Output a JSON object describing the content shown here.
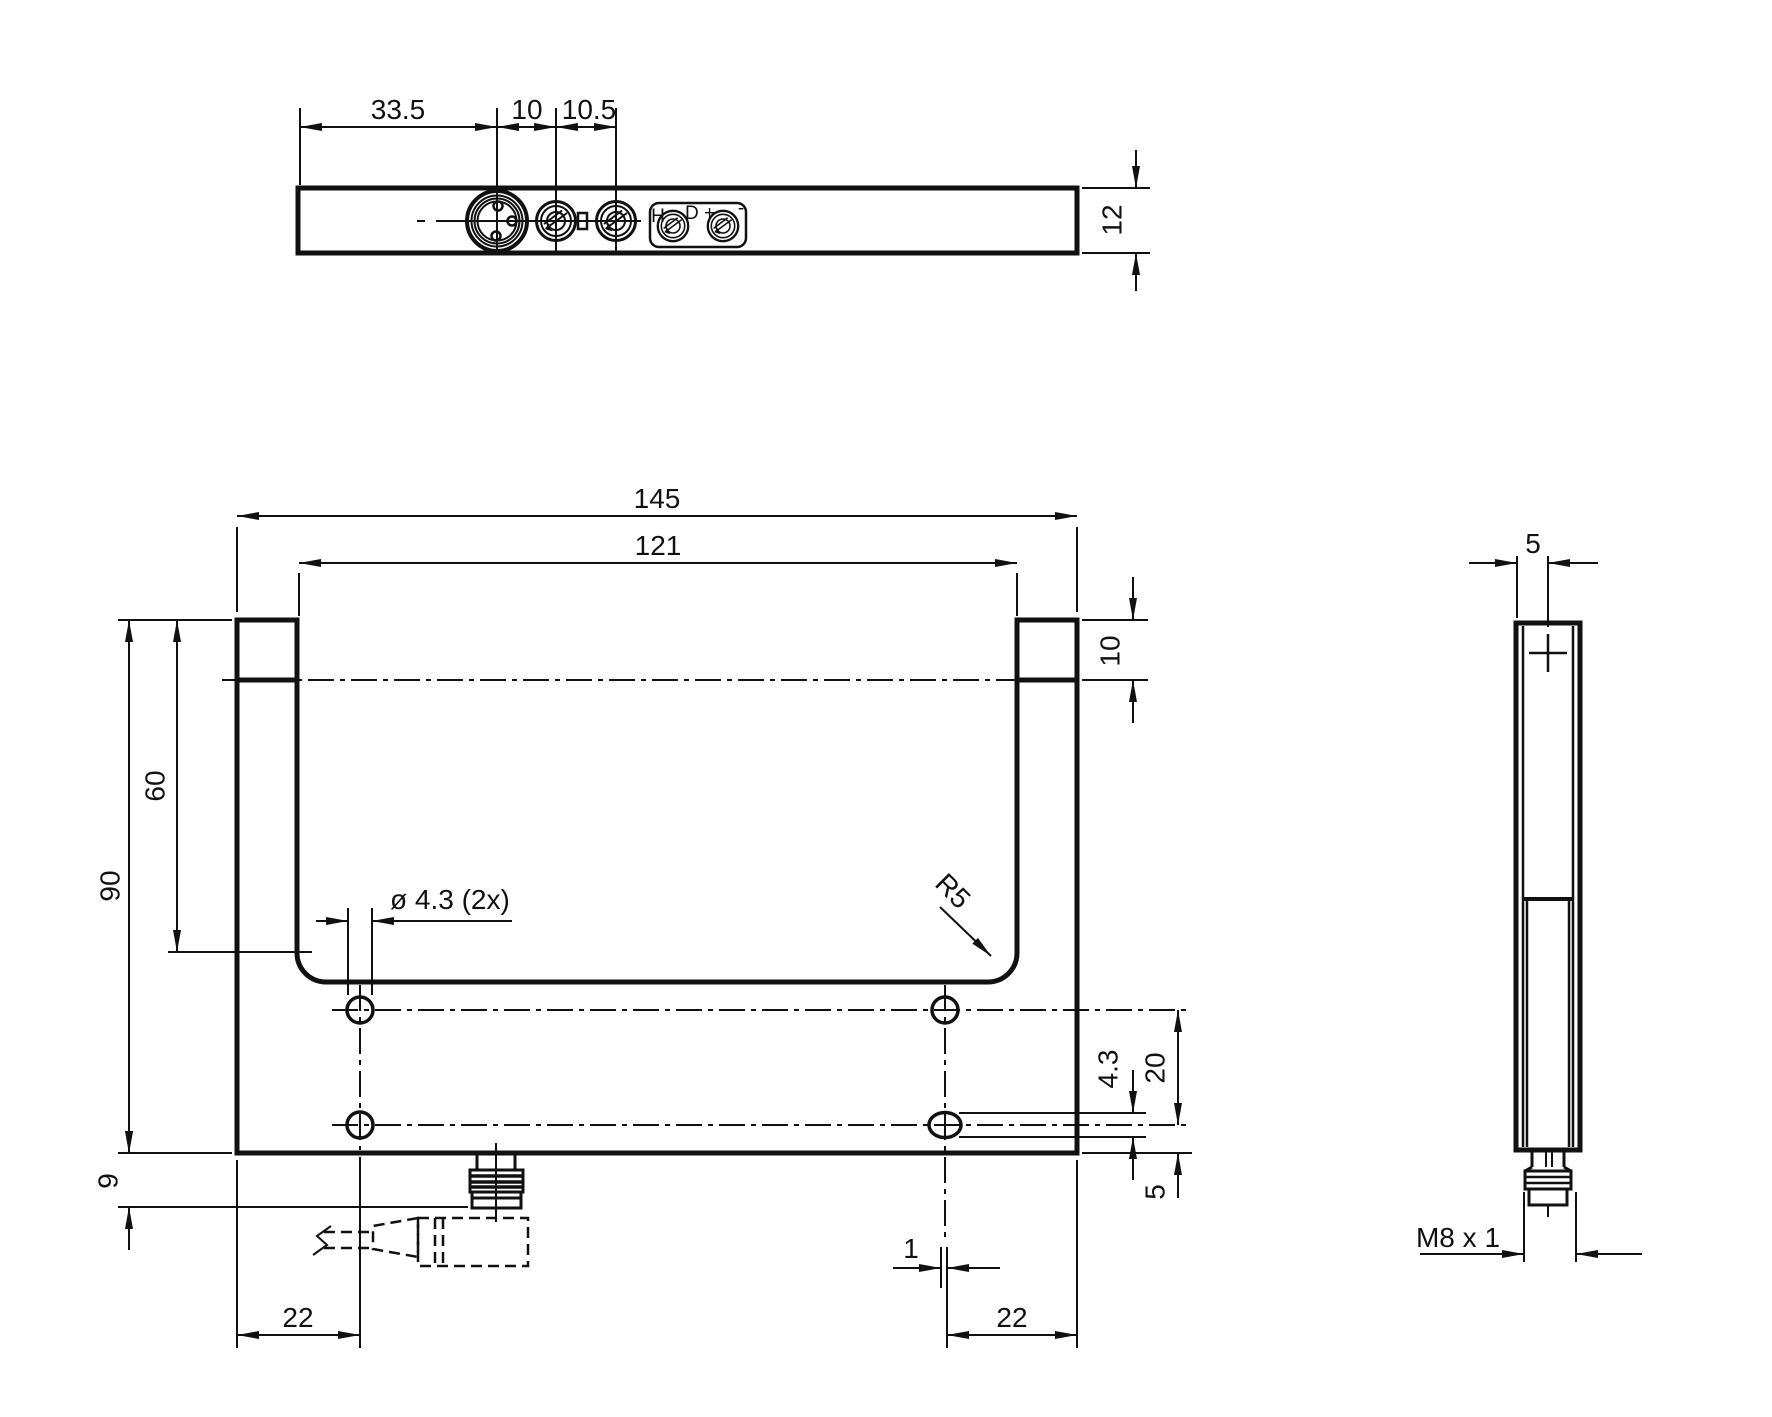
{
  "colors": {
    "ink": "#111111",
    "background": "#ffffff"
  },
  "top_view": {
    "dim_connector_offset": "33.5",
    "dim_pot1_spacing": "10",
    "dim_pot2_spacing": "10.5",
    "dim_thickness": "12",
    "panel_labels": {
      "h": "H",
      "d_plus": "D +",
      "minus": "-"
    }
  },
  "front_view": {
    "dim_width_overall": "145",
    "dim_width_inner": "121",
    "dim_height_overall": "90",
    "dim_slot_depth": "60",
    "dim_connector_height": "9",
    "dim_lens_height": "10",
    "dim_mounting_holes": "ø 4.3 (2x)",
    "dim_corner_radius": "R5",
    "dim_slot_width": "4.3",
    "dim_hole_row_spacing": "20",
    "dim_hole_bottom_offset": "5",
    "dim_slot_elongation": "1",
    "dim_hole_left_offset": "22",
    "dim_hole_right_offset": "22"
  },
  "side_view": {
    "dim_axis_offset": "5",
    "dim_thread": "M8 x 1"
  }
}
